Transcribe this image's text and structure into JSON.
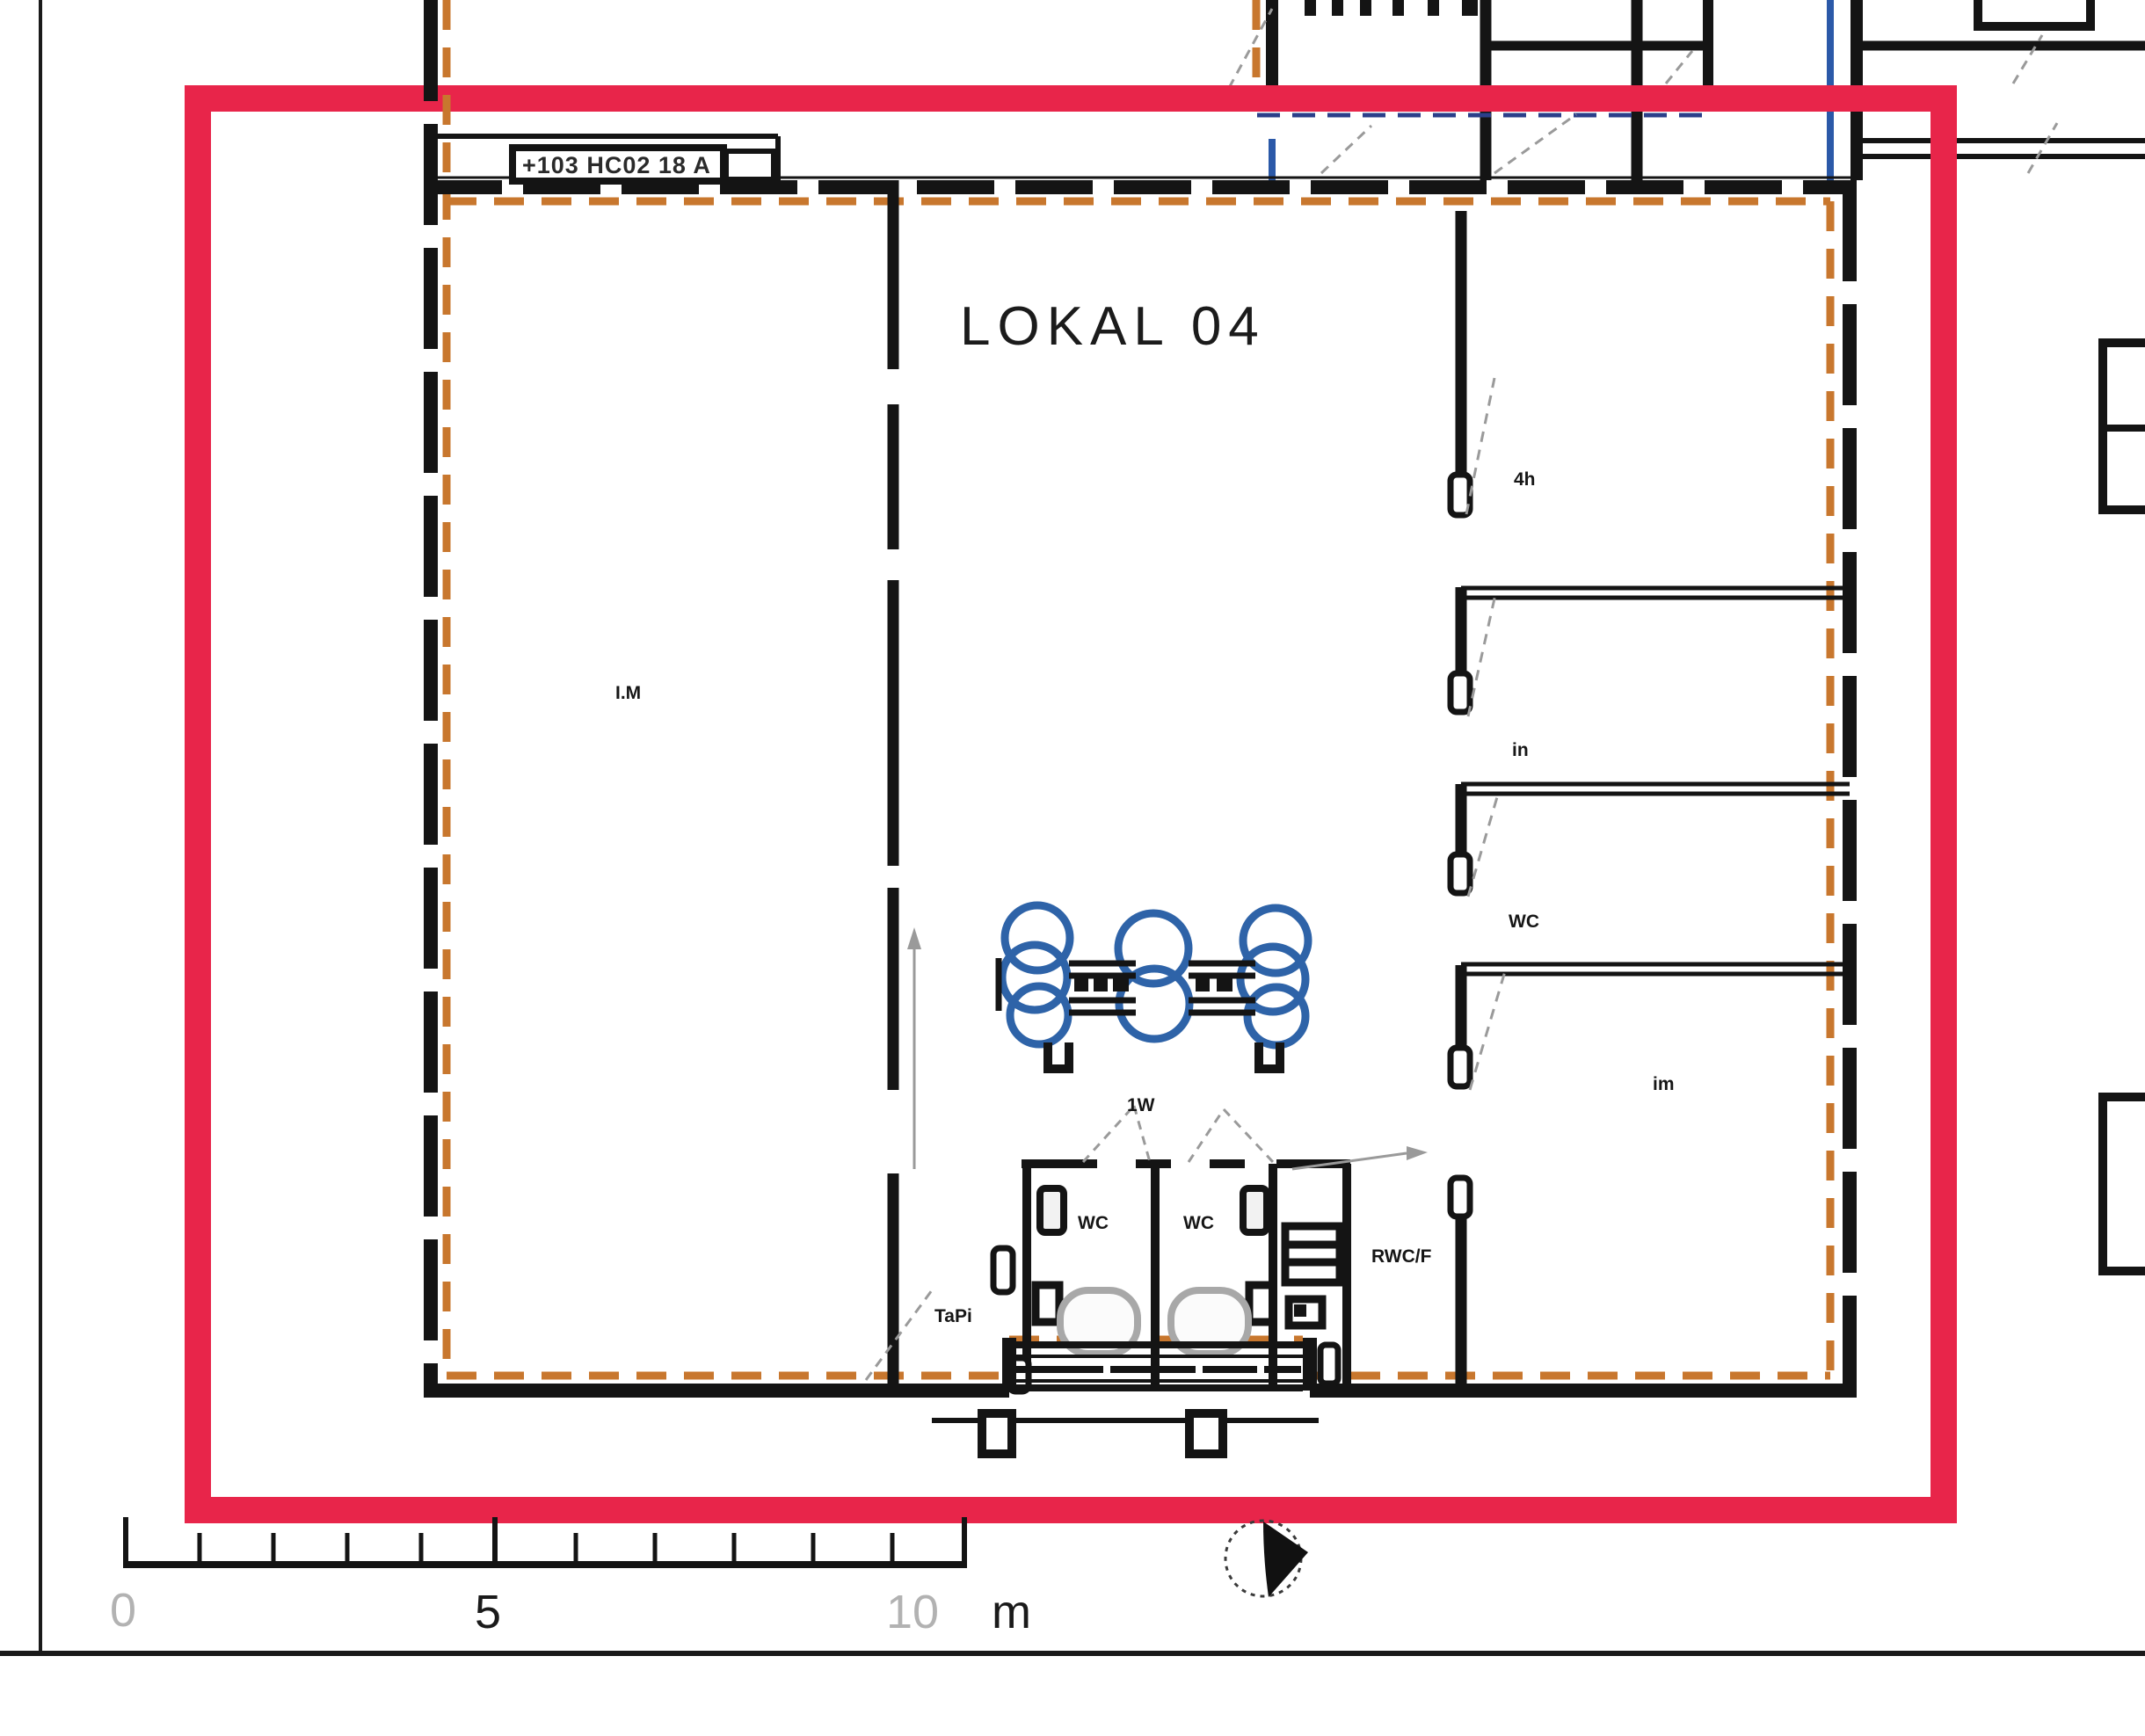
{
  "drawing": {
    "unit_label": "LOKAL 04",
    "entrance_sign": "+103 HC02 18 A",
    "rooms": {
      "main_left": "I.M",
      "office_top": "4h",
      "office_mid": "in",
      "office_low": "WC",
      "storage": "im",
      "wc_left": "WC",
      "wc_right": "WC",
      "rwc": "RWC/F",
      "stair": "TaPi",
      "door_note": "1W"
    },
    "scale_bar": {
      "zero": "0",
      "five": "5",
      "ten": "10",
      "unit": "m"
    },
    "colors": {
      "highlight_red": "#e8254a",
      "boundary_orange": "#c8772e",
      "boundary_blue": "#2b59a8",
      "furniture_blue": "#2e63a8",
      "wall_black": "#141414",
      "annotation_gray": "#9a9a9a",
      "scale_gray": "#b2b2b2"
    }
  }
}
